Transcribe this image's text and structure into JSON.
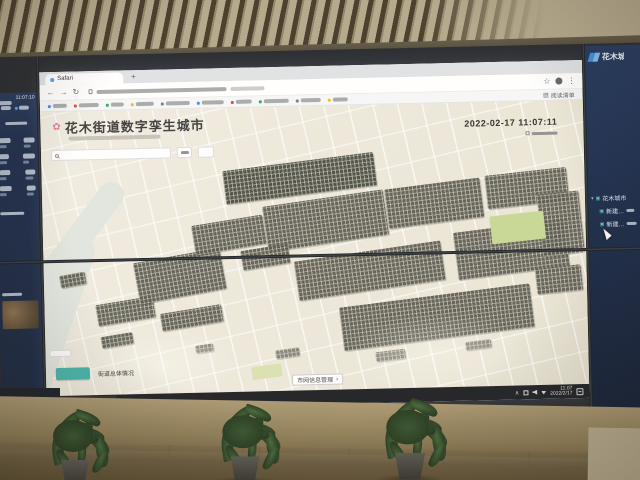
{
  "colors": {
    "teal_accent": "#44b3a9",
    "navy_panel": "#1b2a4a",
    "map_background": "#ece8db",
    "building_gray": "#56554c",
    "taskbar_background": "#1c1e22",
    "flower_pink": "#e2799e"
  },
  "left_screen": {
    "clock": "11:07:10"
  },
  "browser": {
    "tab_title": "Safari",
    "reading_list_label": "阅读清单"
  },
  "app": {
    "title": "花木街道数字孪生城市",
    "timestamp": "2022-02-17 11:07:11",
    "street_overview_label": "街道总体情况",
    "grid_management_label": "市网信息管理",
    "chevron": "›"
  },
  "center_taskbar": {
    "app_button": "Safari - Google…",
    "time": "11:07",
    "date": "2022/2/17"
  },
  "right_screen": {
    "brand": "花木城市",
    "tree_root": "花木城市",
    "tree_children": [
      "新建…",
      "新建…"
    ]
  },
  "icons": {
    "flower": "✿",
    "back": "←",
    "forward": "→",
    "reload": "↻",
    "star": "☆",
    "menu": "⋮",
    "plus": "+",
    "caret_down": "▾",
    "layer": "▣",
    "tray_chevron": "∧",
    "reading_list": "▤"
  }
}
